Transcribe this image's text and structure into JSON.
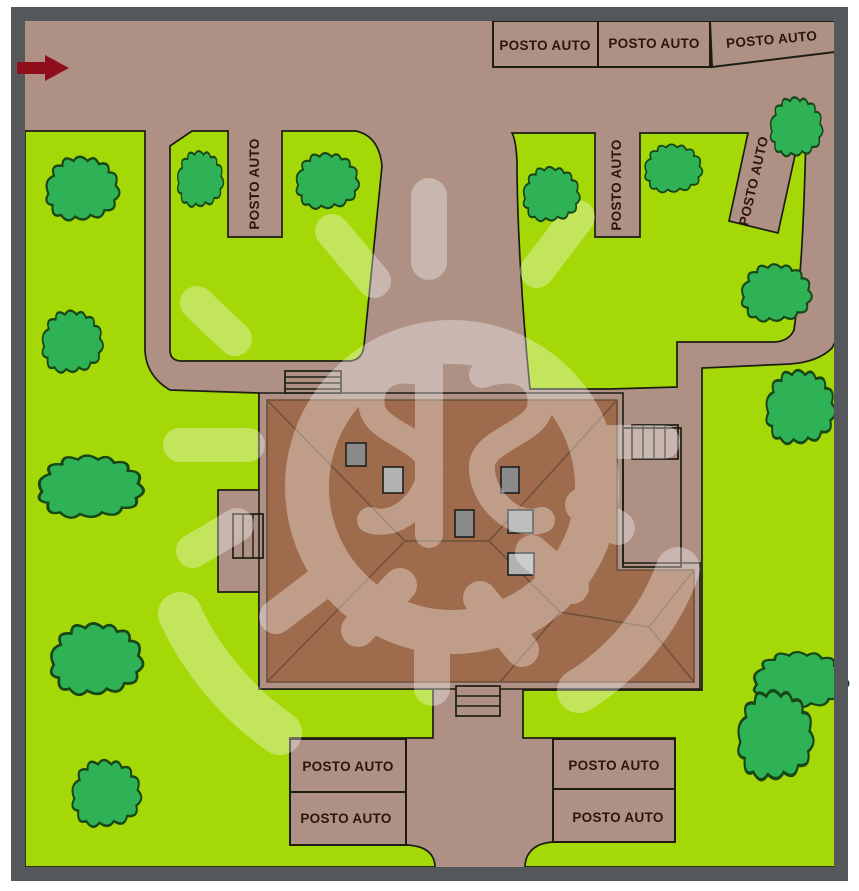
{
  "title": "Site plan with parking bays",
  "parking": {
    "top_row": [
      {
        "label": "POSTO AUTO"
      },
      {
        "label": "POSTO AUTO"
      },
      {
        "label": "POSTO AUTO"
      }
    ],
    "north_left_bay": {
      "label": "POSTO AUTO"
    },
    "north_right_bay": {
      "label": "POSTO AUTO"
    },
    "north_diagonal_bay": {
      "label": "POSTO AUTO"
    },
    "south_left": [
      {
        "label": "POSTO AUTO"
      },
      {
        "label": "POSTO AUTO"
      }
    ],
    "south_right": [
      {
        "label": "POSTO AUTO"
      },
      {
        "label": "POSTO AUTO"
      }
    ]
  },
  "colors": {
    "page": "#ffffff",
    "road": "#ae9184",
    "grass": "#a4d807",
    "tree": "#2fb255",
    "tree_line": "#174617",
    "roof": "#9e6b4c",
    "roof_line": "#6b4f39",
    "line": "#1c1c12",
    "frame": "#54585a",
    "arrow": "#8f0e1c",
    "label": "#2a1708",
    "chimney_dark": "#8a8a8a",
    "chimney_mid": "#9d9d9d",
    "chimney_light": "#b2b2b2",
    "watermark": "#ffffff"
  }
}
